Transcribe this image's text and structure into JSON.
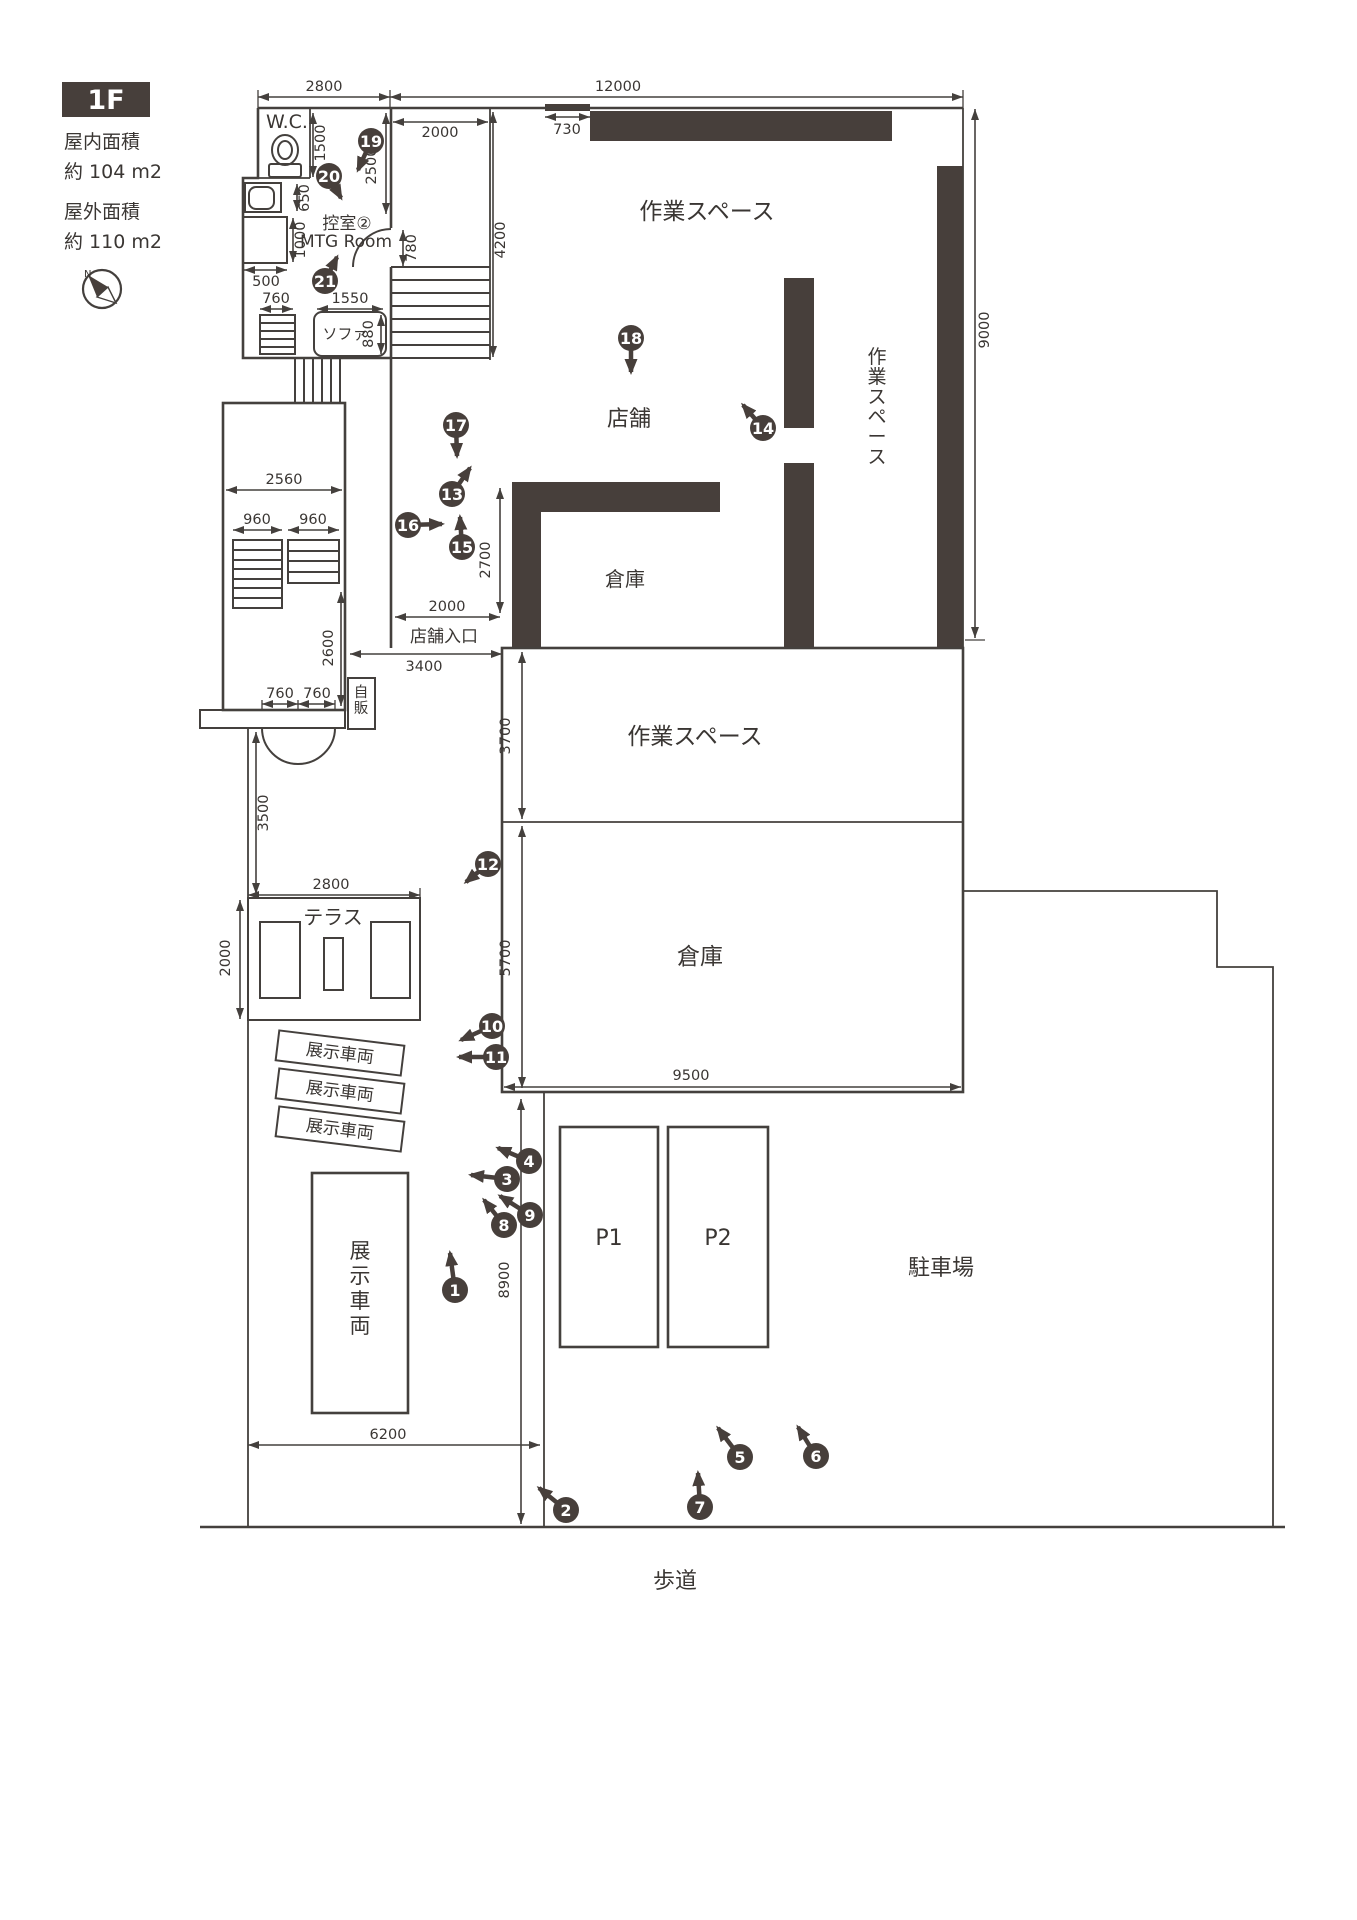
{
  "sidebar": {
    "floor_badge": "1F",
    "indoor_area_label": "屋内面積",
    "indoor_area_value": "約 104 m2",
    "outdoor_area_label": "屋外面積",
    "outdoor_area_value": "約 110 m2",
    "compass_north": "N"
  },
  "rooms": {
    "wc": "W.C.",
    "waiting_room": "控室②",
    "mtg_room": "MTG Room",
    "sofa": "ソファ",
    "workspace_top": "作業スペース",
    "workspace_right": "作業スペース",
    "shop": "店舗",
    "storage_upper": "倉庫",
    "shop_entrance": "店舗入口",
    "vending": "自販",
    "workspace_mid": "作業スペース",
    "storage_mid": "倉庫",
    "terrace": "テラス",
    "display_car_1": "展示車両",
    "display_car_2": "展示車両",
    "display_car_3": "展示車両",
    "display_car_main": "展示車両",
    "p1": "P1",
    "p2": "P2",
    "parking": "駐車場",
    "sidewalk": "歩道"
  },
  "dims": {
    "top_left_2800": "2800",
    "top_right_12000": "12000",
    "stair_2000": "2000",
    "wall_730": "730",
    "stair_4200": "4200",
    "right_9000": "9000",
    "wc_1500": "1500",
    "mtg_2500": "2500",
    "basin_650": "650",
    "counter_1000": "1000",
    "counter_500": "500",
    "shoe_760": "760",
    "sofa_1550": "1550",
    "sofa_880": "880",
    "hall_2560": "2560",
    "stair_960a": "960",
    "stair_960b": "960",
    "hall_2600": "2600",
    "door_760a": "760",
    "door_760b": "760",
    "mtg_door_780": "780",
    "store_2700": "2700",
    "entrance_2000": "2000",
    "entrance_3400": "3400",
    "path_3500": "3500",
    "terrace_2800": "2800",
    "terrace_2000": "2000",
    "workspace_3700": "3700",
    "storage_5700": "5700",
    "storage_9500": "9500",
    "display_6200": "6200",
    "lot_8900": "8900"
  },
  "markers": [
    "1",
    "2",
    "3",
    "4",
    "5",
    "6",
    "7",
    "8",
    "9",
    "10",
    "11",
    "12",
    "13",
    "14",
    "15",
    "16",
    "17",
    "18",
    "19",
    "20",
    "21"
  ]
}
